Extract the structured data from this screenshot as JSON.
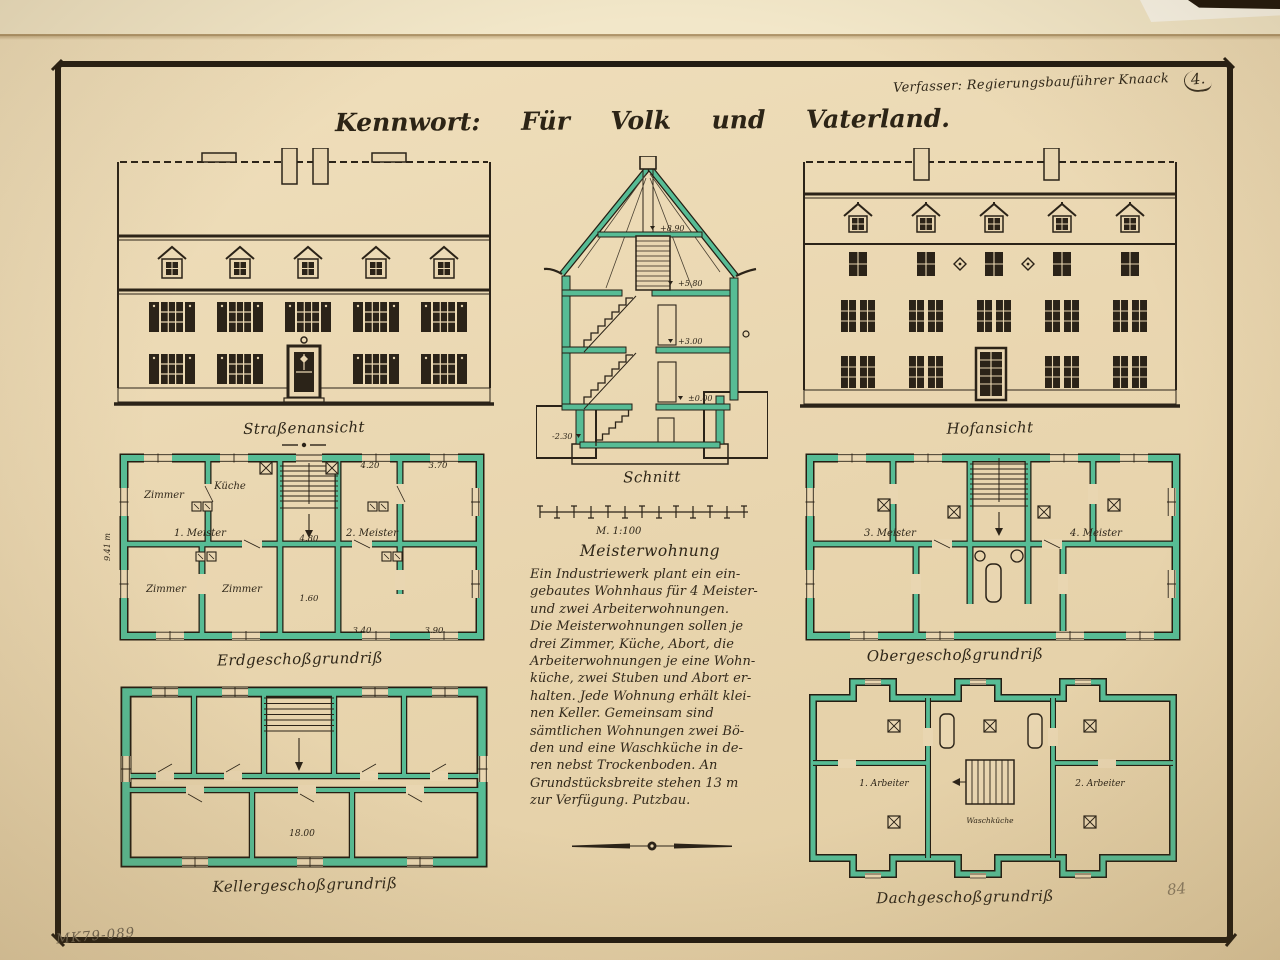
{
  "meta": {
    "author_line": "Verfasser: Regierungsbauführer Knaack",
    "page_number": "4.",
    "pencil_page": "84",
    "catalog_number": "MK79-089"
  },
  "title": {
    "label": "Kennwort:",
    "words": [
      "Für",
      "Volk",
      "und",
      "Vaterland."
    ]
  },
  "drawings": {
    "street_elevation": {
      "caption": "Straßenansicht"
    },
    "section": {
      "caption": "Schnitt",
      "levels": [
        "+8.90",
        "+5.80",
        "+3.00",
        "±0.00",
        "-2.30"
      ],
      "scale": "M. 1:100"
    },
    "courtyard_elevation": {
      "caption": "Hofansicht"
    },
    "ground_floor": {
      "caption": "Erdgeschoßgrundriß",
      "rooms": [
        "Zimmer",
        "Küche",
        "1. Meister",
        "2. Meister",
        "Zimmer",
        "Zimmer"
      ],
      "dims": [
        "4.20",
        "3.70",
        "4.80",
        "1.60",
        "3.40",
        "3.90"
      ],
      "depth_dim": "9.41 m"
    },
    "upper_floor": {
      "caption": "Obergeschoßgrundriß",
      "rooms": [
        "3. Meister",
        "4. Meister"
      ]
    },
    "basement": {
      "caption": "Kellergeschoßgrundriß",
      "dim": "18.00"
    },
    "attic": {
      "caption": "Dachgeschoßgrundriß",
      "rooms": [
        "1. Arbeiter",
        "Waschküche",
        "2. Arbeiter"
      ]
    }
  },
  "description": {
    "heading": "Meisterwohnung",
    "lines": [
      "Ein Industriewerk plant ein ein-",
      "gebautes Wohnhaus für 4 Meister-",
      "und zwei Arbeiterwohnungen.",
      "Die Meisterwohnungen sollen je",
      "drei Zimmer, Küche, Abort, die",
      "Arbeiterwohnungen je eine Wohn-",
      "küche, zwei Stuben und Abort er-",
      "halten. Jede Wohnung erhält klei-",
      "nen Keller. Gemeinsam sind",
      "sämtlichen Wohnungen zwei Bö-",
      "den und eine Waschküche in de-",
      "ren nebst Trockenboden. An",
      "Grundstücksbreite stehen 13 m",
      "zur Verfügung. Putzbau."
    ]
  },
  "colors": {
    "paper": "#e9d6b1",
    "ink": "#2b2318",
    "wall_green": "#57bc95",
    "pencil": "#8a7c63"
  }
}
